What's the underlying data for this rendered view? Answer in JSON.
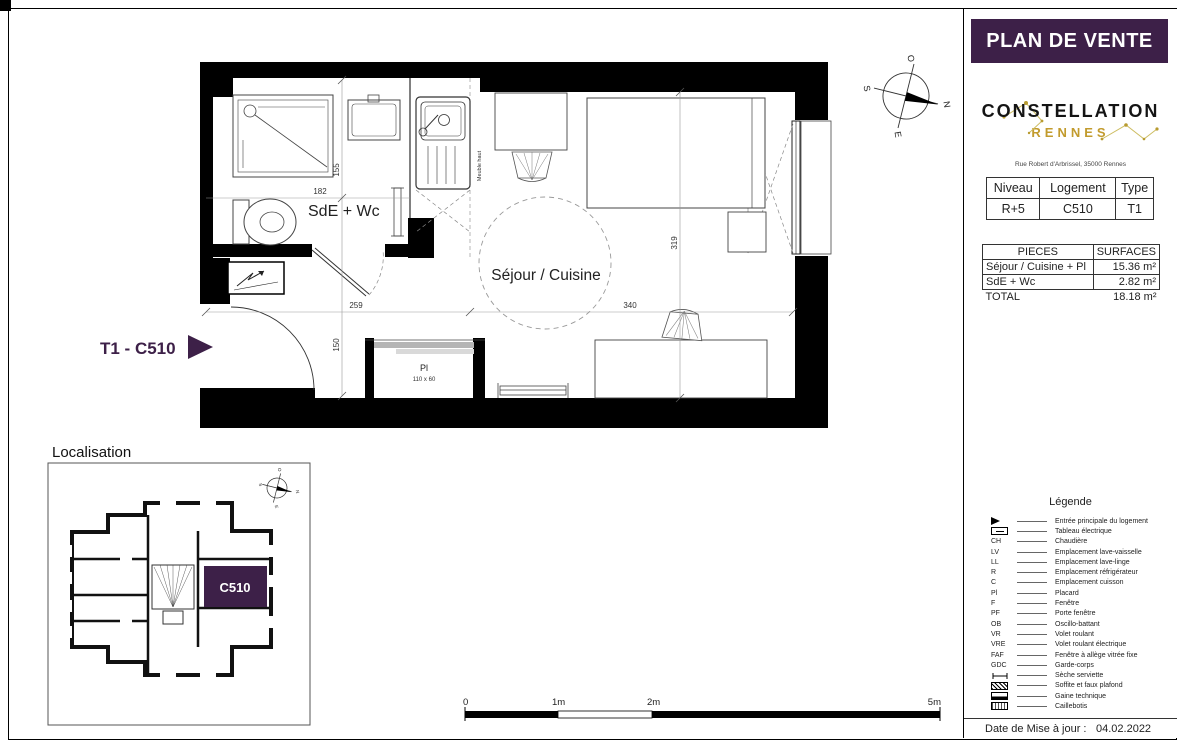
{
  "page": {
    "title": "PLAN DE VENTE",
    "date_label": "Date de Mise à jour :",
    "date_value": "04.02.2022"
  },
  "logo": {
    "name": "CONSTELLATION",
    "city": "RENNES",
    "address": "Rue Robert d'Arbrissel, 35000 Rennes"
  },
  "unit_table": {
    "headers": [
      "Niveau",
      "Logement",
      "Type"
    ],
    "row": [
      "R+5",
      "C510",
      "T1"
    ]
  },
  "surfaces_table": {
    "headers": [
      "PIECES",
      "SURFACES"
    ],
    "rows": [
      {
        "piece": "Séjour / Cuisine + Pl",
        "surface": "15.36 m²"
      },
      {
        "piece": "SdE + Wc",
        "surface": "2.82 m²"
      }
    ],
    "total_label": "TOTAL",
    "total_value": "18.18 m²"
  },
  "legend": {
    "title": "Légende",
    "items": [
      {
        "code": "",
        "symbol": "entrance-arrow",
        "label": "Entrée principale du logement"
      },
      {
        "code": "",
        "symbol": "electrical-panel",
        "label": "Tableau électrique"
      },
      {
        "code": "CH",
        "symbol": "",
        "label": "Chaudière"
      },
      {
        "code": "LV",
        "symbol": "",
        "label": "Emplacement lave-vaisselle"
      },
      {
        "code": "LL",
        "symbol": "",
        "label": "Emplacement lave-linge"
      },
      {
        "code": "R",
        "symbol": "",
        "label": "Emplacement réfrigérateur"
      },
      {
        "code": "C",
        "symbol": "",
        "label": "Emplacement cuisson"
      },
      {
        "code": "Pl",
        "symbol": "",
        "label": "Placard"
      },
      {
        "code": "F",
        "symbol": "",
        "label": "Fenêtre"
      },
      {
        "code": "PF",
        "symbol": "",
        "label": "Porte fenêtre"
      },
      {
        "code": "OB",
        "symbol": "",
        "label": "Oscillo-battant"
      },
      {
        "code": "VR",
        "symbol": "",
        "label": "Volet roulant"
      },
      {
        "code": "VRE",
        "symbol": "",
        "label": "Volet roulant électrique"
      },
      {
        "code": "FAF",
        "symbol": "",
        "label": "Fenêtre à allège vitrée fixe"
      },
      {
        "code": "GDC",
        "symbol": "",
        "label": "Garde-corps"
      },
      {
        "code": "",
        "symbol": "towel-dryer",
        "label": "Sèche serviette"
      },
      {
        "code": "",
        "symbol": "hatch",
        "label": "Soffite et faux plafond"
      },
      {
        "code": "",
        "symbol": "duct",
        "label": "Gaine technique"
      },
      {
        "code": "",
        "symbol": "grating",
        "label": "Caillebotis"
      }
    ]
  },
  "plan": {
    "unit_label": "T1 - C510",
    "rooms": {
      "bathroom": "SdE + Wc",
      "living": "Séjour / Cuisine"
    },
    "closet": {
      "code": "Pl",
      "size": "110 x 60"
    },
    "annotations": {
      "upper_cabinet": "Meuble haut",
      "window_codes": "PF OB VRE"
    },
    "dimensions": {
      "bathroom_height": "155",
      "bathroom_width": "182",
      "entry_width": "259",
      "entry_height": "150",
      "living_width": "340",
      "living_height": "319"
    }
  },
  "localisation": {
    "title": "Localisation",
    "unit": "C510"
  },
  "scalebar": {
    "labels": [
      "0",
      "1m",
      "2m",
      "5m"
    ]
  },
  "compass": {
    "north": "N",
    "south": "S",
    "east": "E",
    "west": "O"
  },
  "colors": {
    "accent_purple": "#3d2048",
    "gold": "#c29b2d"
  }
}
